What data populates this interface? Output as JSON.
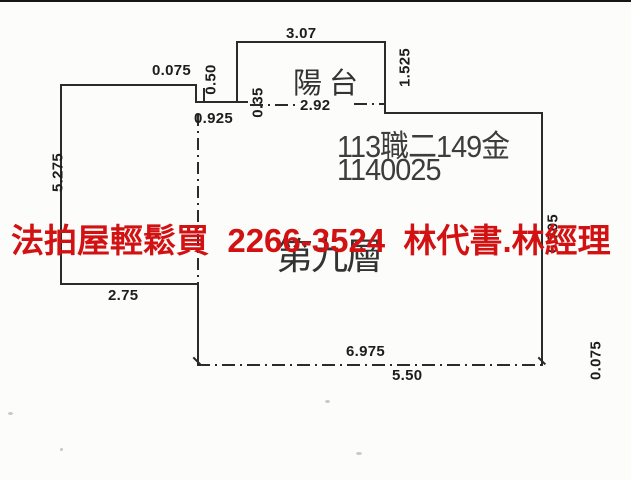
{
  "plan": {
    "balcony": "陽台",
    "case_line1": "113職二149金",
    "case_line2": "1140025",
    "stamp": "第九層",
    "dims": {
      "balcony_width": "3.07",
      "top_left_offset": "0.075",
      "step_height": "0.50",
      "seg_0925": "0.925",
      "seg_035": "0.35",
      "seg_292": "2.92",
      "balcony_height": "1.525",
      "left_height": "5.275",
      "left_bottom_width": "2.75",
      "bottom_width_outer": "6.975",
      "bottom_width_inner": "5.50",
      "right_bottom_offset": "0.075",
      "right_height": "6.705"
    },
    "line_color": "#2b2b2b"
  },
  "ad": {
    "text": "法拍屋輕鬆買  2266-3524  林代書.林經理",
    "color": "#d21212"
  }
}
